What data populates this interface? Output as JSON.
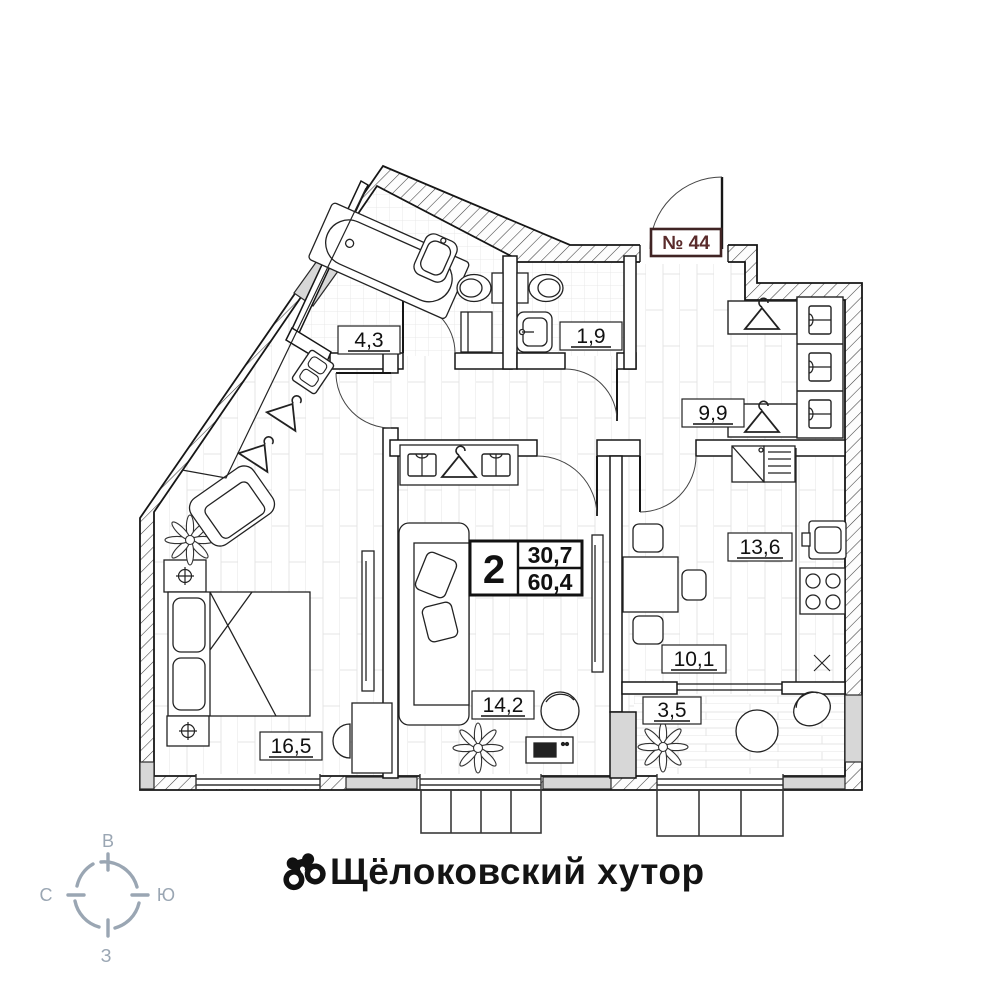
{
  "plan": {
    "apartment_number": "№ 44",
    "summary": {
      "rooms_count": "2",
      "living_area": "30,7",
      "total_area": "60,4"
    },
    "rooms": [
      {
        "id": "bathroom",
        "area": "4,3"
      },
      {
        "id": "toilet",
        "area": "1,9"
      },
      {
        "id": "hallway",
        "area": "9,9"
      },
      {
        "id": "kitchen",
        "area": "13,6"
      },
      {
        "id": "dining",
        "area": "10,1"
      },
      {
        "id": "loggia",
        "area": "3,5"
      },
      {
        "id": "living-room",
        "area": "14,2"
      },
      {
        "id": "bedroom",
        "area": "16,5"
      }
    ]
  },
  "compass": {
    "top": "В",
    "right": "Ю",
    "bottom": "З",
    "left": "С"
  },
  "footer": {
    "title": "Щёлоковский хутор",
    "logo_icon": "binoculars-icon"
  },
  "colors": {
    "apartment_number": "#5a2b2b",
    "apartment_number_border": "#402424",
    "compass": "#9aa6b3",
    "walls": "#161616",
    "wall_gray": "#d7d7d7"
  }
}
